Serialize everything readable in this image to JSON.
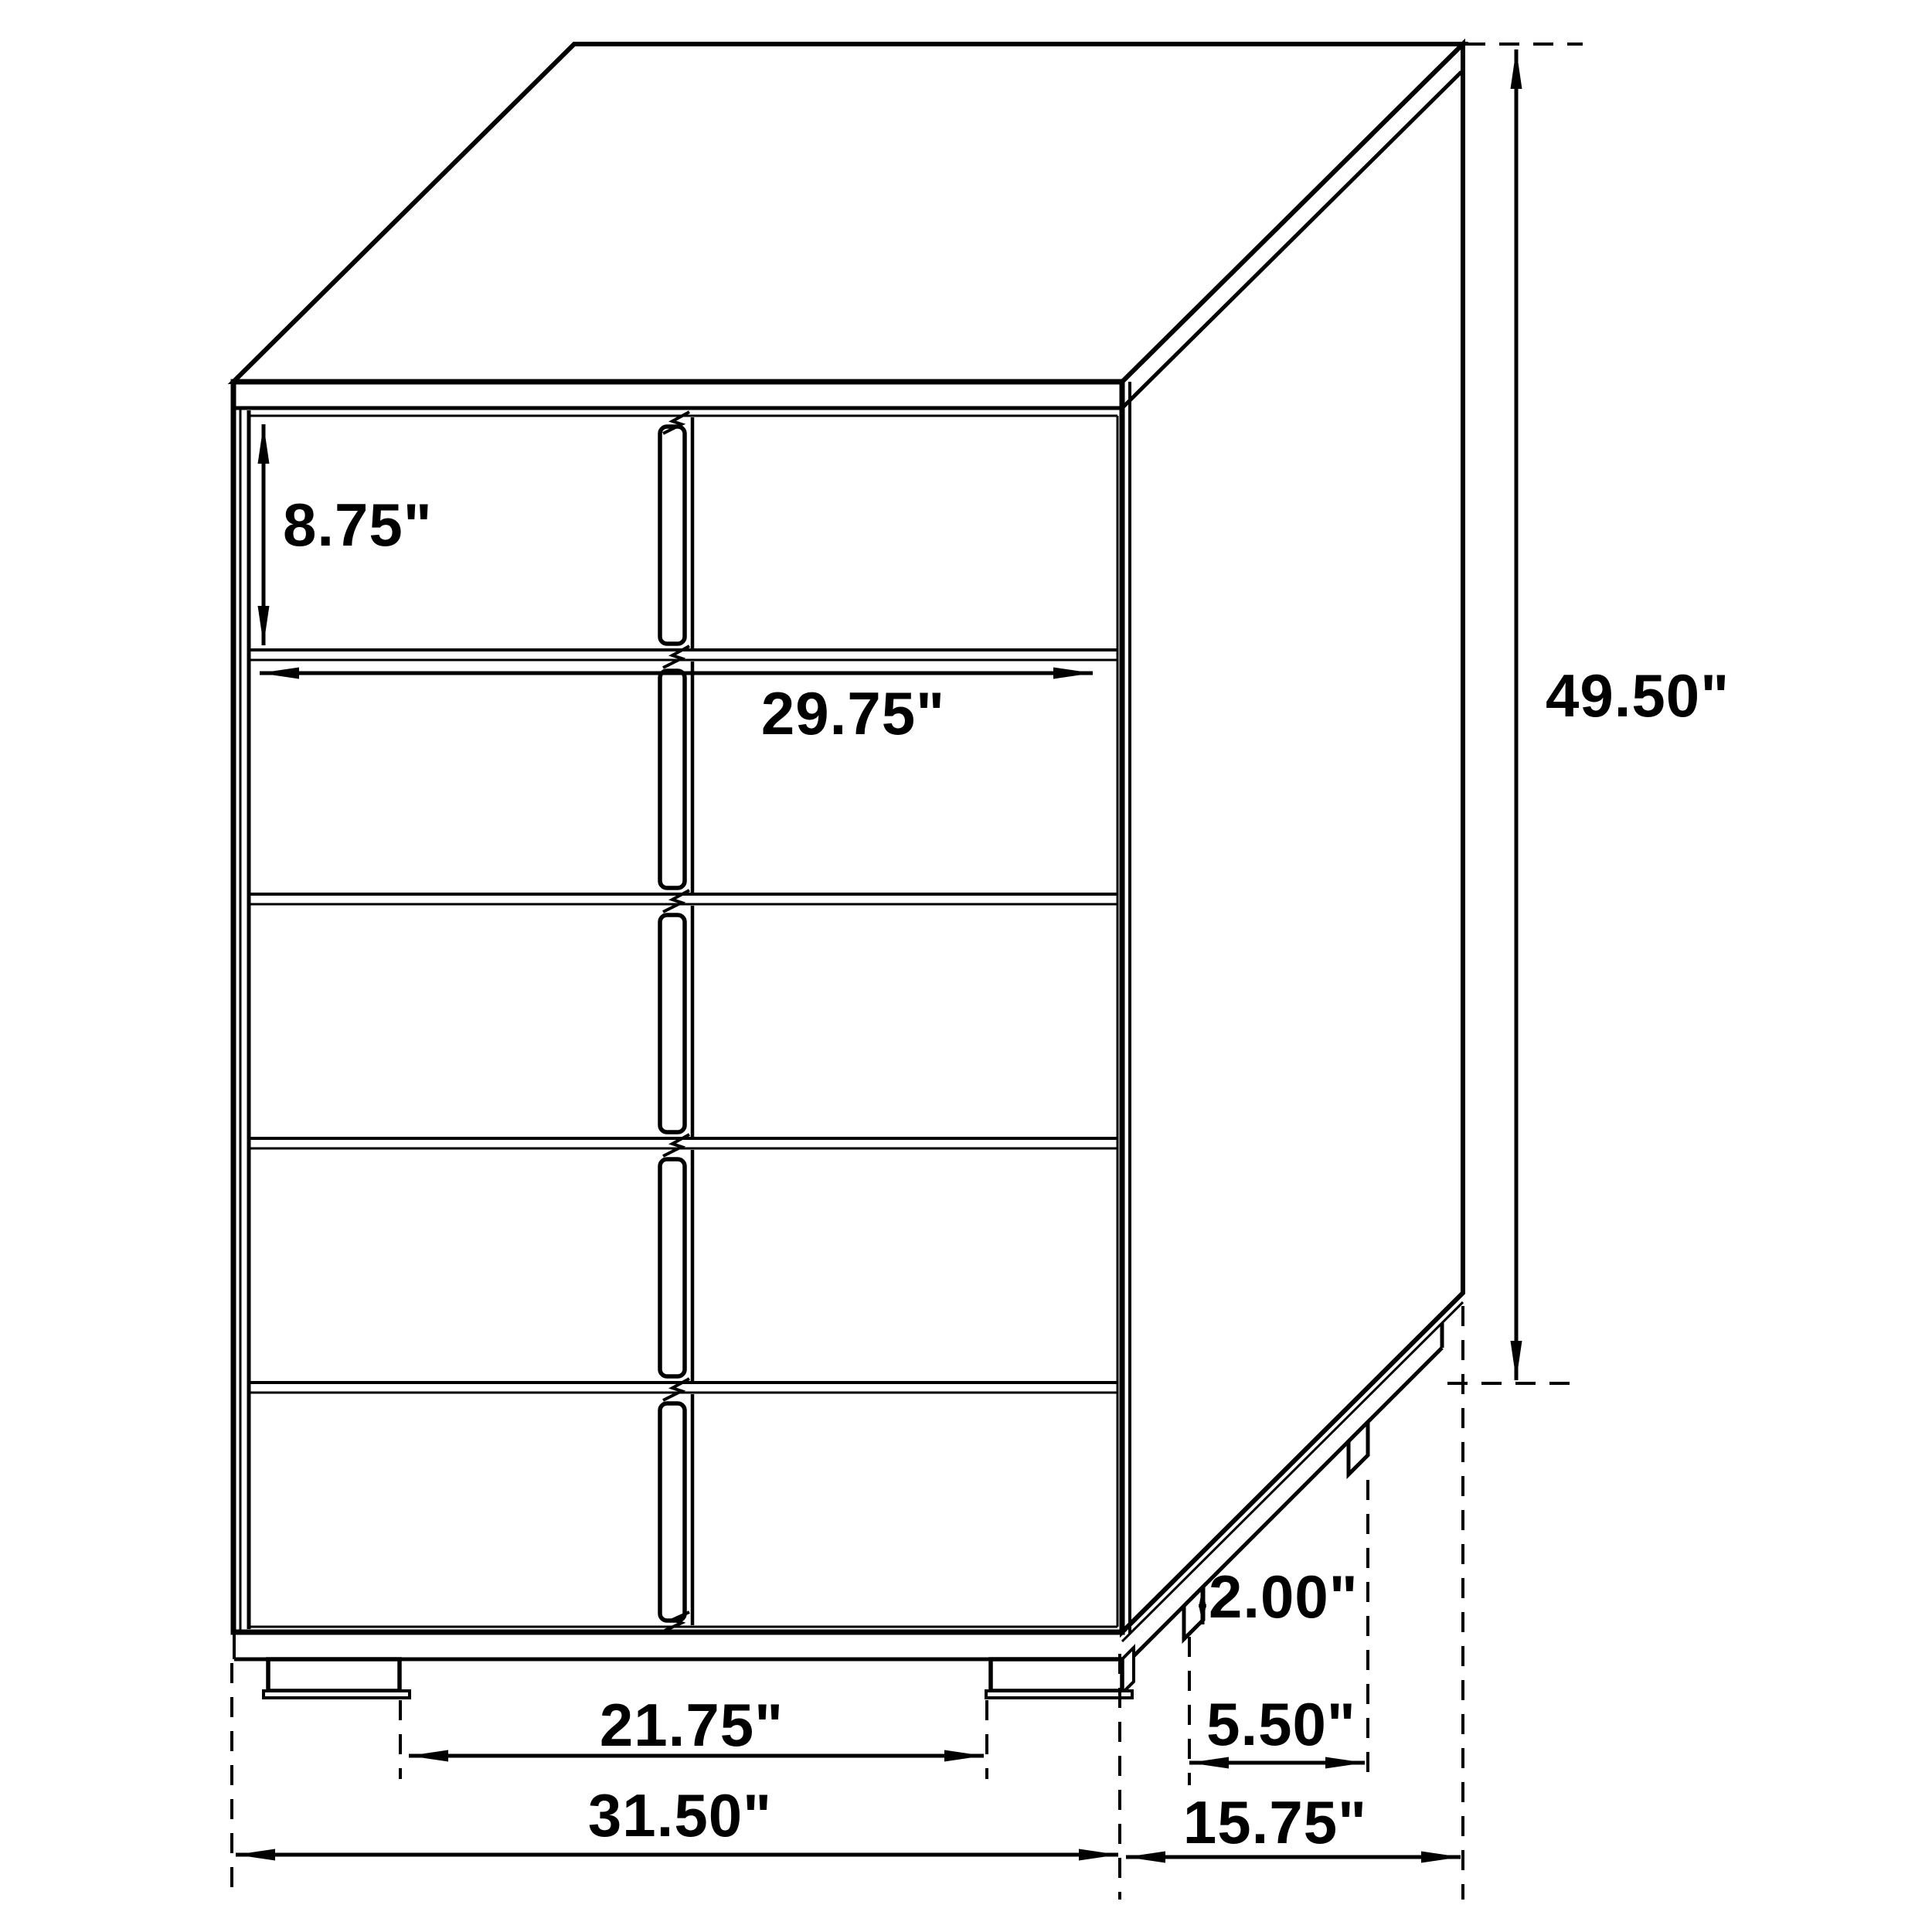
{
  "diagram": {
    "kind": "furniture-dimension-line-drawing",
    "object": "five-drawer-chest",
    "colors": {
      "line": "#000000",
      "background": "#ffffff",
      "text": "#000000"
    },
    "dimensions": {
      "drawer_front_height": "8.75\"",
      "drawer_width": "29.75\"",
      "overall_height": "49.50\"",
      "leg_height": "2.00\"",
      "side_leg_spacing": "5.50\"",
      "overall_depth": "15.75\"",
      "front_leg_spacing": "21.75\"",
      "overall_width": "31.50\""
    }
  }
}
